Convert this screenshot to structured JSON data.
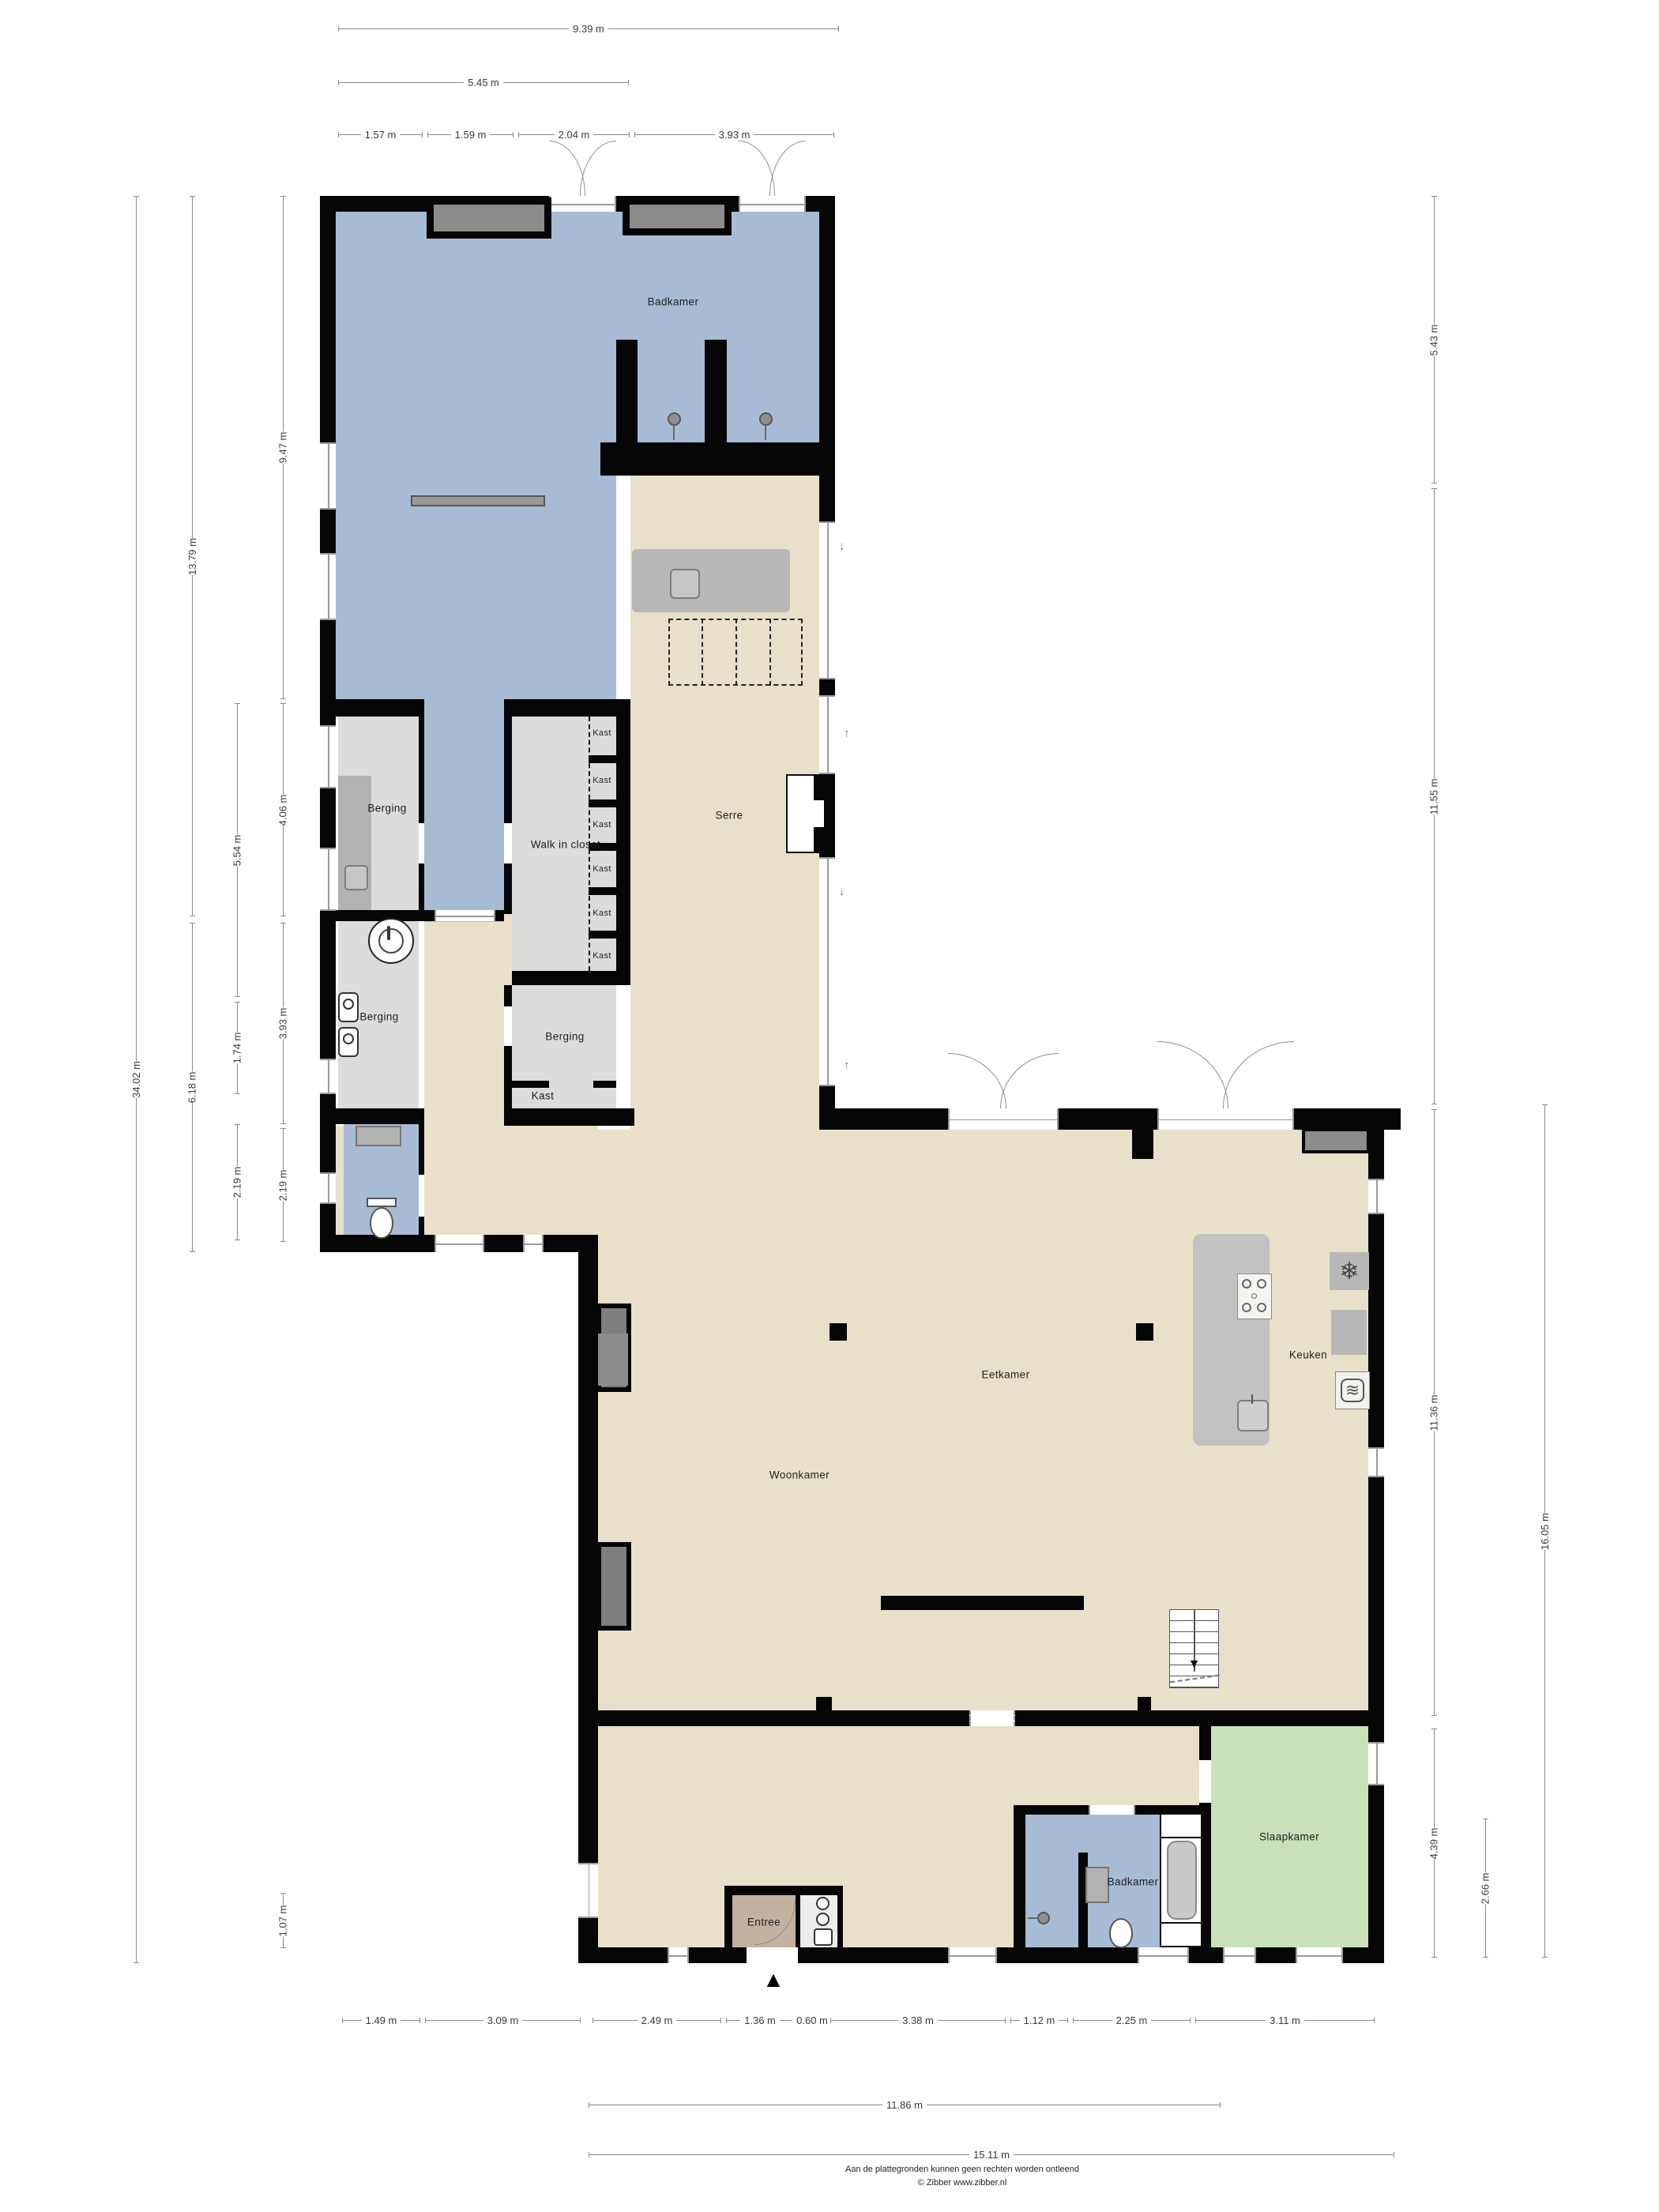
{
  "title": "Begane grond plattegrond",
  "rooms": {
    "badkamer_boven": "Badkamer",
    "berging_boven": "Berging",
    "walk_in_closet": "Walk in closet",
    "serre": "Serre",
    "berging_midden": "Berging",
    "kast_room": "Kast",
    "berging_onder": "Berging",
    "eetkamer": "Eetkamer",
    "keuken": "Keuken",
    "woonkamer": "Woonkamer",
    "slaapkamer": "Slaapkamer",
    "badkamer_beneden": "Badkamer",
    "entree": "Entree"
  },
  "closet_shelves": [
    "Kast",
    "Kast",
    "Kast",
    "Kast",
    "Kast",
    "Kast"
  ],
  "dims": {
    "top": [
      "9.39 m",
      "5.45 m",
      "1.57 m",
      "1.59 m",
      "2.04 m",
      "3.93 m"
    ],
    "left": [
      "34.02 m",
      "13.79 m",
      "6.18 m",
      "5.54 m",
      "1.74 m",
      "2.19 m",
      "9.47 m",
      "4.06 m",
      "3.93 m",
      "2.19 m",
      "1.07 m"
    ],
    "right": [
      "5.43 m",
      "11.55 m",
      "11.36 m",
      "4.39 m",
      "2.66 m",
      "16.05 m"
    ],
    "bottom": [
      "1.49 m",
      "3.09 m",
      "2.49 m",
      "1.36 m",
      "0.60 m",
      "3.38 m",
      "1.12 m",
      "2.25 m",
      "3.11 m",
      "11.86 m",
      "15.11 m"
    ]
  },
  "glyphs": {
    "north_arrow": "▲",
    "snowflake": "❄",
    "oven_waves": "≋",
    "arrow_down": "↓",
    "arrow_up": "↑",
    "stairs_arrow": "▼"
  },
  "colors": {
    "wall": "#060606",
    "floor_living": "#e8e0c9",
    "floor_wet": "#a7bbd5",
    "floor_storage": "#dcdcdc",
    "floor_bedroom": "#c9e0b8",
    "floor_entree": "#c3b1a0",
    "furniture": "#b2b2b2",
    "wall_panel": "#8c8c8c",
    "dim_line": "#8a8a8a"
  },
  "footer": {
    "line1": "Aan de plattegronden kunnen geen rechten worden ontleend",
    "line2": "© Zibber www.zibber.nl"
  }
}
